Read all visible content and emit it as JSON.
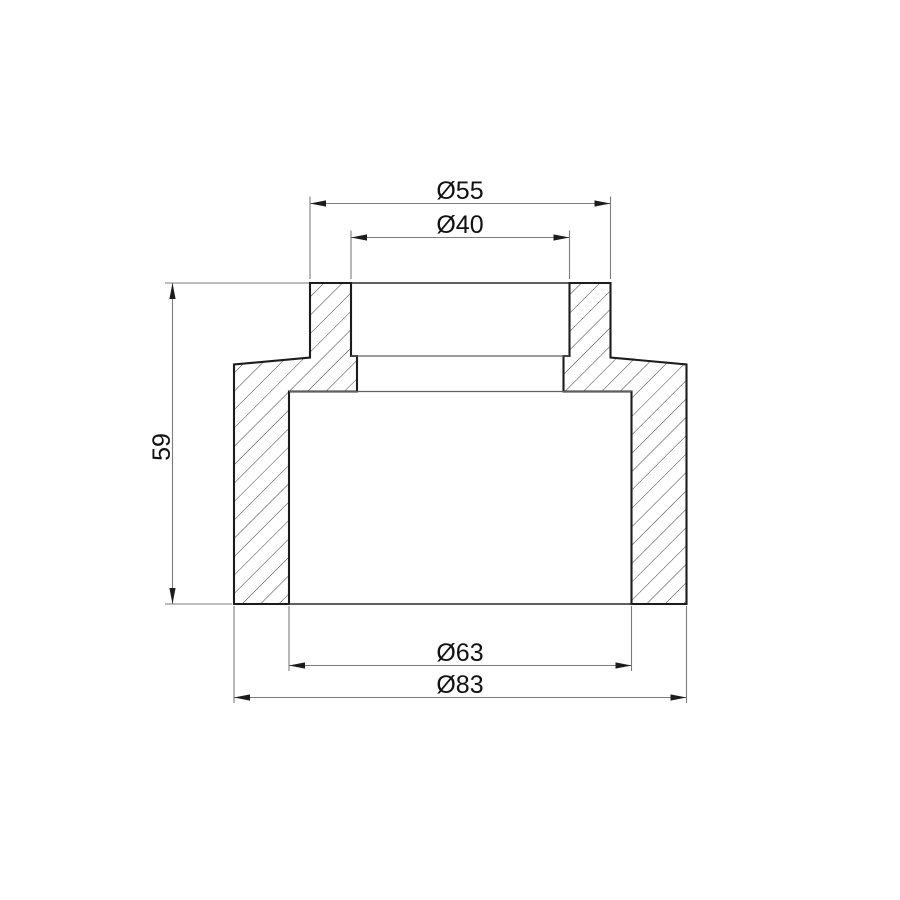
{
  "page": {
    "background": "#ffffff"
  },
  "drawing": {
    "kind": "technical-section-drawing",
    "view": "cross-section of reducing socket fitting with hatched cut walls",
    "colors": {
      "outline": "#1c1c1c",
      "hatch": "#3d3d3d",
      "dimension_lines": "#7c7c7c",
      "text": "#111111",
      "background": "#ffffff"
    },
    "dimensions": [
      {
        "id": "top-outer-diameter",
        "label": "Ø55",
        "value": 55,
        "placement": "top"
      },
      {
        "id": "top-inner-diameter",
        "label": "Ø40",
        "value": 40,
        "placement": "top"
      },
      {
        "id": "overall-height",
        "label": "59",
        "value": 59,
        "placement": "left"
      },
      {
        "id": "bottom-inner-diameter",
        "label": "Ø63",
        "value": 63,
        "placement": "bottom"
      },
      {
        "id": "bottom-outer-diameter",
        "label": "Ø83",
        "value": 83,
        "placement": "bottom"
      }
    ]
  }
}
